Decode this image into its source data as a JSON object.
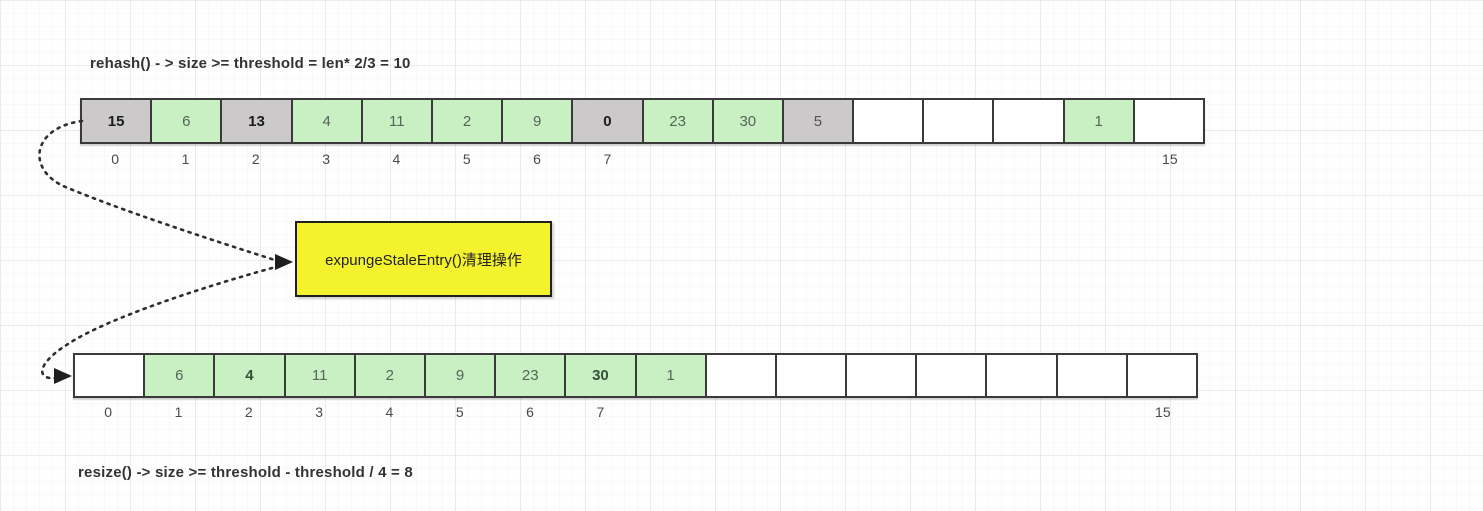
{
  "titles": {
    "top": "rehash() - > size >= threshold = len* 2/3 = 10",
    "bottom": "resize() -> size >= threshold - threshold / 4 = 8"
  },
  "note_box": {
    "label": "expungeStaleEntry()清理操作",
    "fill": "#f4f22c",
    "border_color": "#1f1f1f"
  },
  "cell_colors": {
    "green": "#c9f0c3",
    "stale": "#cbc9c9",
    "empty": "#ffffff"
  },
  "text_colors": {
    "green": "#57655a",
    "green_bold": "#36503a",
    "stale": "#555555",
    "stale_bold": "#1c1c1c"
  },
  "arrow_color": "#2e2e2e",
  "arrays": {
    "top": {
      "cells": [
        {
          "value": "15",
          "state": "stale",
          "bold": true
        },
        {
          "value": "6",
          "state": "green",
          "bold": false
        },
        {
          "value": "13",
          "state": "stale",
          "bold": true
        },
        {
          "value": "4",
          "state": "green",
          "bold": false
        },
        {
          "value": "11",
          "state": "green",
          "bold": false
        },
        {
          "value": "2",
          "state": "green",
          "bold": false
        },
        {
          "value": "9",
          "state": "green",
          "bold": false
        },
        {
          "value": "0",
          "state": "stale",
          "bold": true
        },
        {
          "value": "23",
          "state": "green",
          "bold": false
        },
        {
          "value": "30",
          "state": "green",
          "bold": false
        },
        {
          "value": "5",
          "state": "stale",
          "bold": false
        },
        {
          "value": "",
          "state": "empty",
          "bold": false
        },
        {
          "value": "",
          "state": "empty",
          "bold": false
        },
        {
          "value": "",
          "state": "empty",
          "bold": false
        },
        {
          "value": "1",
          "state": "green",
          "bold": false
        },
        {
          "value": "",
          "state": "empty",
          "bold": false
        }
      ],
      "index_labels": [
        "0",
        "1",
        "2",
        "3",
        "4",
        "5",
        "6",
        "7",
        "",
        "",
        "",
        "",
        "",
        "",
        "",
        "15"
      ]
    },
    "bottom": {
      "cells": [
        {
          "value": "",
          "state": "empty",
          "bold": false
        },
        {
          "value": "6",
          "state": "green",
          "bold": false
        },
        {
          "value": "4",
          "state": "green",
          "bold": true
        },
        {
          "value": "11",
          "state": "green",
          "bold": false
        },
        {
          "value": "2",
          "state": "green",
          "bold": false
        },
        {
          "value": "9",
          "state": "green",
          "bold": false
        },
        {
          "value": "23",
          "state": "green",
          "bold": false
        },
        {
          "value": "30",
          "state": "green",
          "bold": true
        },
        {
          "value": "1",
          "state": "green",
          "bold": false
        },
        {
          "value": "",
          "state": "empty",
          "bold": false
        },
        {
          "value": "",
          "state": "empty",
          "bold": false
        },
        {
          "value": "",
          "state": "empty",
          "bold": false
        },
        {
          "value": "",
          "state": "empty",
          "bold": false
        },
        {
          "value": "",
          "state": "empty",
          "bold": false
        },
        {
          "value": "",
          "state": "empty",
          "bold": false
        },
        {
          "value": "",
          "state": "empty",
          "bold": false
        }
      ],
      "index_labels": [
        "0",
        "1",
        "2",
        "3",
        "4",
        "5",
        "6",
        "7",
        "",
        "",
        "",
        "",
        "",
        "",
        "",
        "15"
      ]
    }
  }
}
